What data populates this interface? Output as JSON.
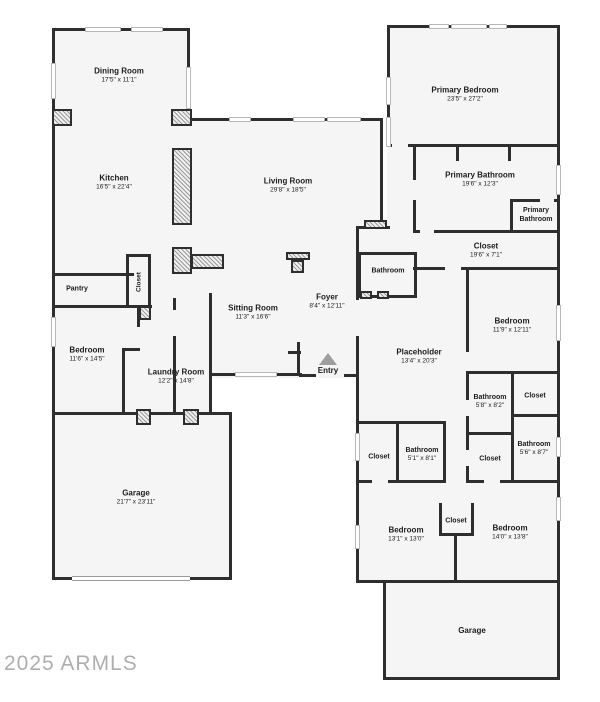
{
  "watermark": "2025 ARMLS",
  "colors": {
    "wall": "#2e2e2e",
    "floor": "#f5f5f5",
    "fixture_hatch": "#9c9c9c",
    "entry_marker": "#9e9e9e",
    "watermark": "#aeaeae"
  },
  "rooms": {
    "dining": {
      "name": "Dining Room",
      "dims": "17'5\" x 11'1\""
    },
    "kitchen": {
      "name": "Kitchen",
      "dims": "16'5\" x 22'4\""
    },
    "pantry": {
      "name": "Pantry"
    },
    "closet_kitchen": {
      "name": "Closet"
    },
    "living": {
      "name": "Living Room",
      "dims": "29'8\" x 18'5\""
    },
    "sitting": {
      "name": "Sitting Room",
      "dims": "11'3\" x 16'6\""
    },
    "foyer": {
      "name": "Foyer",
      "dims": "8'4\" x 12'11\""
    },
    "entry": {
      "name": "Entry"
    },
    "bathroom_hall": {
      "name": "Bathroom"
    },
    "bedroom_left": {
      "name": "Bedroom",
      "dims": "11'6\" x 14'5\""
    },
    "laundry": {
      "name": "Laundry Room",
      "dims": "12'2\" x 14'8\""
    },
    "garage_left": {
      "name": "Garage",
      "dims": "21'7\" x 23'11\""
    },
    "primary_bedroom": {
      "name": "Primary Bedroom",
      "dims": "23'5\" x 27'2\""
    },
    "primary_bathroom": {
      "name": "Primary Bathroom",
      "dims": "19'6\" x 12'3\""
    },
    "primary_bathroom2": {
      "name": "Primary Bathroom"
    },
    "closet_primary": {
      "name": "Closet",
      "dims": "19'6\" x 7'1\""
    },
    "bedroom_right": {
      "name": "Bedroom",
      "dims": "11'9\" x 12'11\""
    },
    "placeholder": {
      "name": "Placeholder",
      "dims": "13'4\" x 20'3\""
    },
    "bathroom_58": {
      "name": "Bathroom",
      "dims": "5'8\" x 8'2\""
    },
    "closet_a": {
      "name": "Closet"
    },
    "closet_b": {
      "name": "Closet"
    },
    "bathroom_51": {
      "name": "Bathroom",
      "dims": "5'1\" x 8'1\""
    },
    "closet_c": {
      "name": "Closet"
    },
    "bathroom_56": {
      "name": "Bathroom",
      "dims": "5'6\" x 8'7\""
    },
    "bedroom_b1": {
      "name": "Bedroom",
      "dims": "13'1\" x 13'0\""
    },
    "closet_mid": {
      "name": "Closet"
    },
    "bedroom_b2": {
      "name": "Bedroom",
      "dims": "14'0\" x 13'8\""
    },
    "garage_right": {
      "name": "Garage"
    }
  }
}
